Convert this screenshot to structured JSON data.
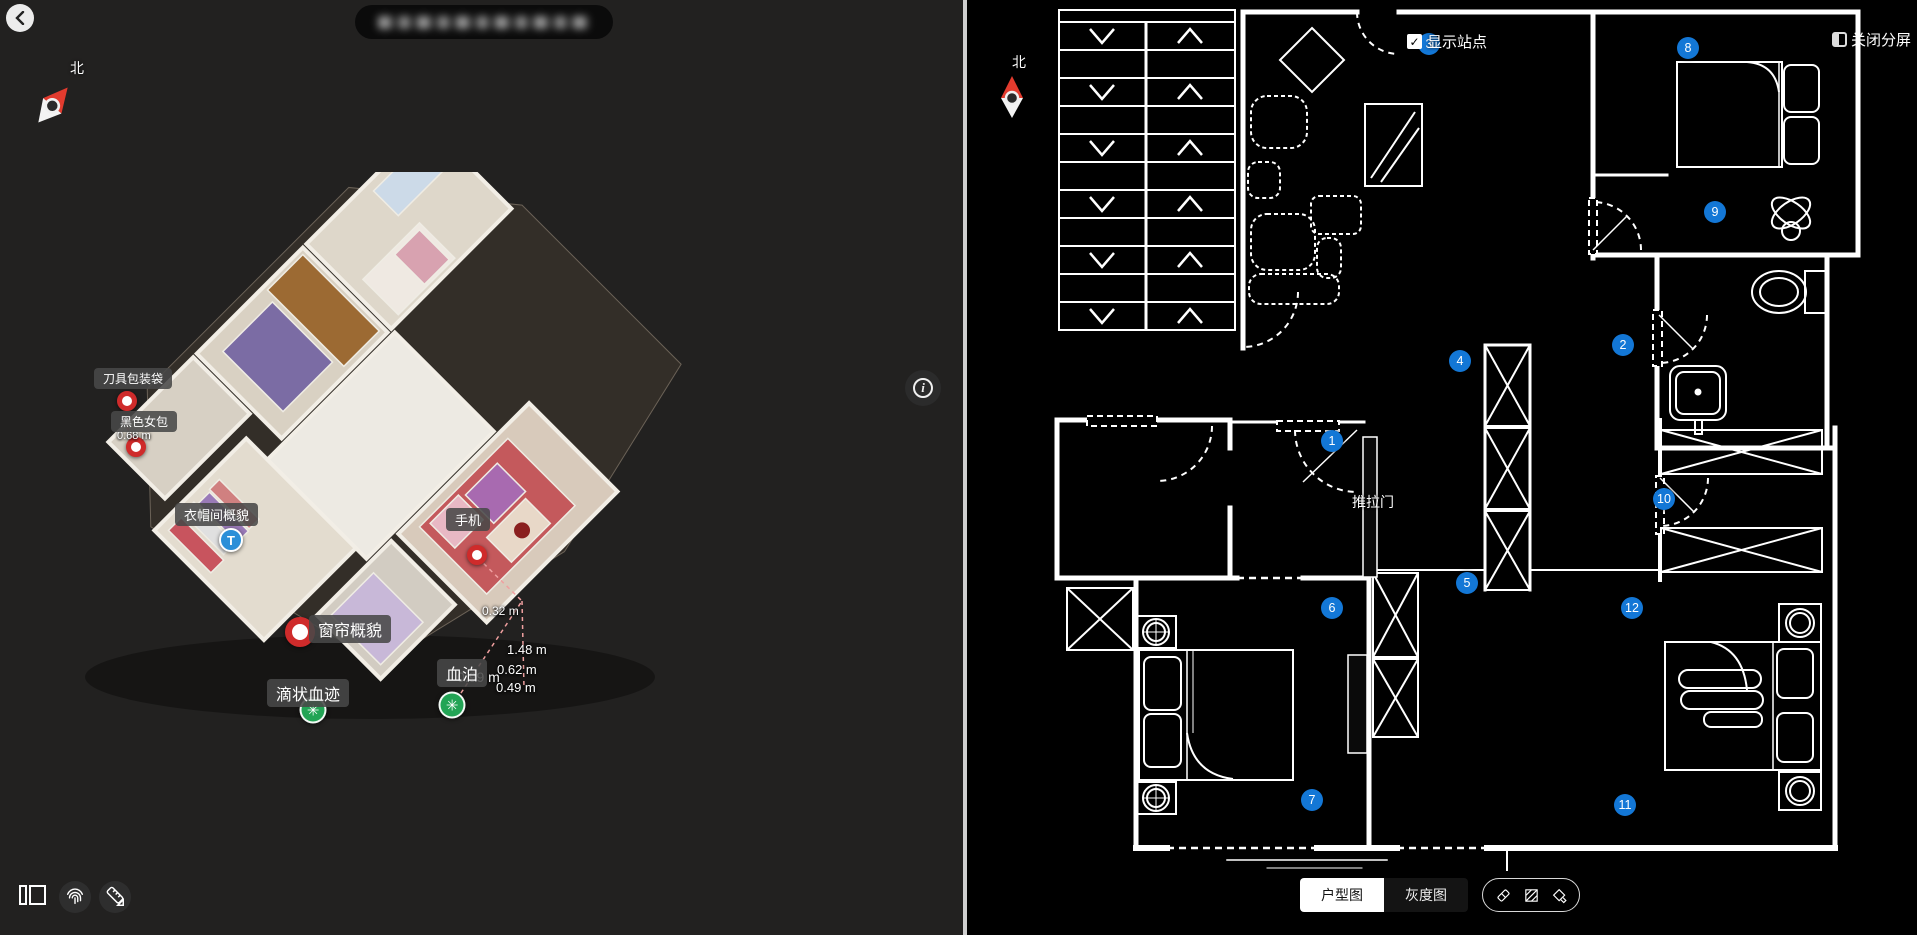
{
  "colors": {
    "accent_blue": "#1377d6",
    "evidence_red": "#cf2b2b",
    "bio_green": "#22a455",
    "tag_blue": "#2b8fd8",
    "compass_red": "#e23b2e"
  },
  "left_panel": {
    "back_icon": "‹",
    "compass_label": "北",
    "info_icon": "i",
    "annotations": [
      {
        "id": "knife-bag",
        "label": "刀具包装袋",
        "marker": "red",
        "lx": 94,
        "ly": 368,
        "mx": 127,
        "my": 401,
        "fs": 12
      },
      {
        "id": "black-bag",
        "label": "黑色女包",
        "marker": "red",
        "lx": 111,
        "ly": 411,
        "mx": 136,
        "my": 447,
        "fs": 12
      },
      {
        "id": "cloakroom",
        "label": "衣帽间概貌",
        "marker": "blue-t",
        "lx": 175,
        "ly": 503,
        "mx": 231,
        "my": 540,
        "fs": 13
      },
      {
        "id": "phone",
        "label": "手机",
        "marker": "red",
        "lx": 446,
        "ly": 508,
        "mx": 477,
        "my": 555,
        "fs": 13
      },
      {
        "id": "curtain",
        "label": "窗帘概貌",
        "marker": "red-large",
        "lx": 309,
        "ly": 615,
        "mx": 300,
        "my": 632,
        "fs": 16
      },
      {
        "id": "blood-pool",
        "label": "血泊",
        "marker": "green",
        "lx": 437,
        "ly": 659,
        "mx": 452,
        "my": 705,
        "fs": 16
      },
      {
        "id": "drip-blood",
        "label": "滴状血迹",
        "marker": "green",
        "lx": 267,
        "ly": 679,
        "mx": 313,
        "my": 710,
        "fs": 16
      }
    ],
    "marker_glyphs": {
      "blue-t": "T",
      "green": "✳"
    },
    "measurements": [
      {
        "text": "0.68 m",
        "x": 117,
        "y": 430,
        "fs": 11
      },
      {
        "text": "0.32 m",
        "x": 482,
        "y": 604,
        "fs": 12
      },
      {
        "text": "1.48 m",
        "x": 507,
        "y": 642,
        "fs": 13
      },
      {
        "text": "0.62 m",
        "x": 497,
        "y": 662,
        "fs": 13
      },
      {
        "text": "0.99 m",
        "x": 457,
        "y": 669,
        "fs": 14
      },
      {
        "text": "0.49 m",
        "x": 496,
        "y": 680,
        "fs": 13
      }
    ]
  },
  "right_panel": {
    "compass_label": "北",
    "show_stations_label": "显示站点",
    "show_stations_checked": "✓",
    "close_split_label": "关闭分屏",
    "sliding_door_label": "推拉门",
    "stations": [
      {
        "n": "1",
        "x": 365,
        "y": 441
      },
      {
        "n": "2",
        "x": 656,
        "y": 345
      },
      {
        "n": "3",
        "x": 462,
        "y": 44
      },
      {
        "n": "4",
        "x": 493,
        "y": 361
      },
      {
        "n": "5",
        "x": 500,
        "y": 583
      },
      {
        "n": "6",
        "x": 365,
        "y": 608
      },
      {
        "n": "7",
        "x": 345,
        "y": 800
      },
      {
        "n": "8",
        "x": 721,
        "y": 48
      },
      {
        "n": "9",
        "x": 748,
        "y": 212
      },
      {
        "n": "10",
        "x": 697,
        "y": 499
      },
      {
        "n": "11",
        "x": 658,
        "y": 805
      },
      {
        "n": "12",
        "x": 665,
        "y": 608
      }
    ],
    "toolbar": {
      "floorplan_label": "户型图",
      "grayscale_label": "灰度图"
    }
  }
}
